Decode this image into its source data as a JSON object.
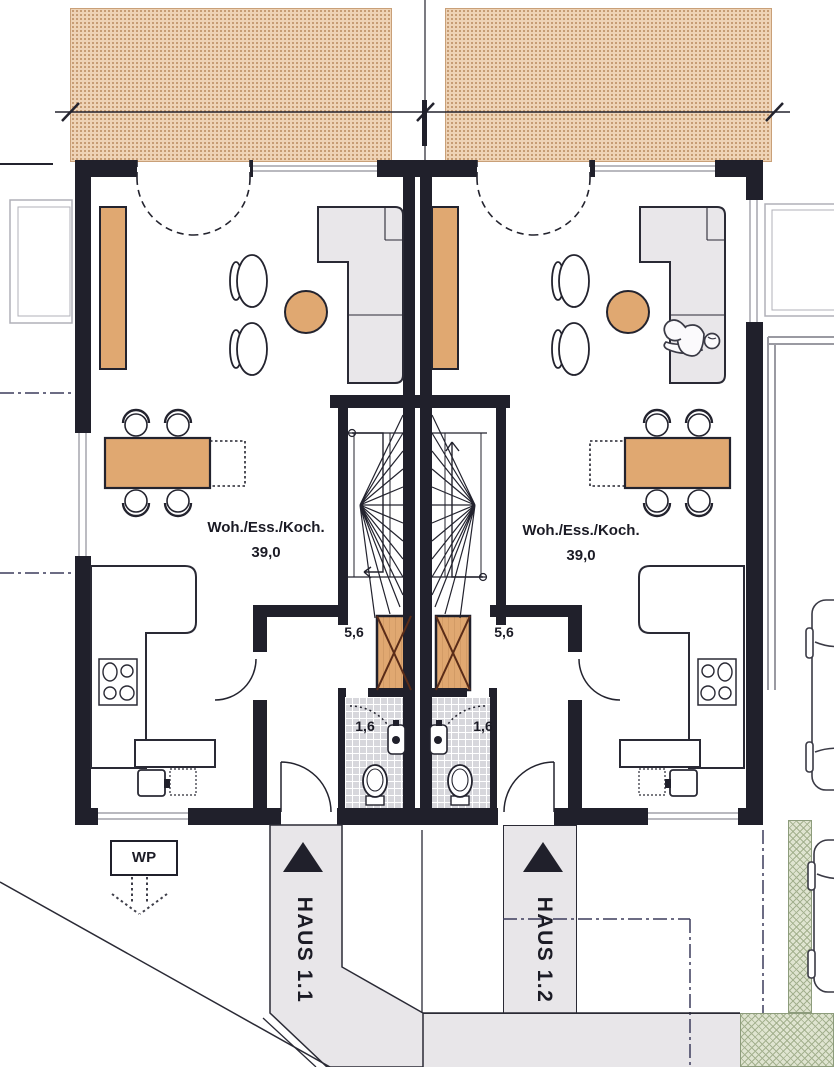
{
  "plan": {
    "houses": [
      {
        "id": "haus-1-1",
        "label": "HAUS 1.1",
        "living": {
          "name": "Woh./Ess./Koch.",
          "area": "39,0"
        },
        "hall": {
          "area": "5,6"
        },
        "wc": {
          "area": "1,6"
        }
      },
      {
        "id": "haus-1-2",
        "label": "HAUS 1.2",
        "living": {
          "name": "Woh./Ess./Koch.",
          "area": "39,0"
        },
        "hall": {
          "area": "5,6"
        },
        "wc": {
          "area": "1,6"
        }
      }
    ],
    "annotations": {
      "heat_pump": "WP"
    },
    "colors": {
      "wall": "#20202b",
      "terrace_fill": "#eed3b6",
      "terrace_dot": "#b98a5e",
      "wood": "#e0a871",
      "tile": "#d7d7dc",
      "sofa": "#e9e7ea",
      "path_gray": "#e8e6e9",
      "green": "#dfe4d0",
      "boundary": "#3c3c5c"
    }
  }
}
